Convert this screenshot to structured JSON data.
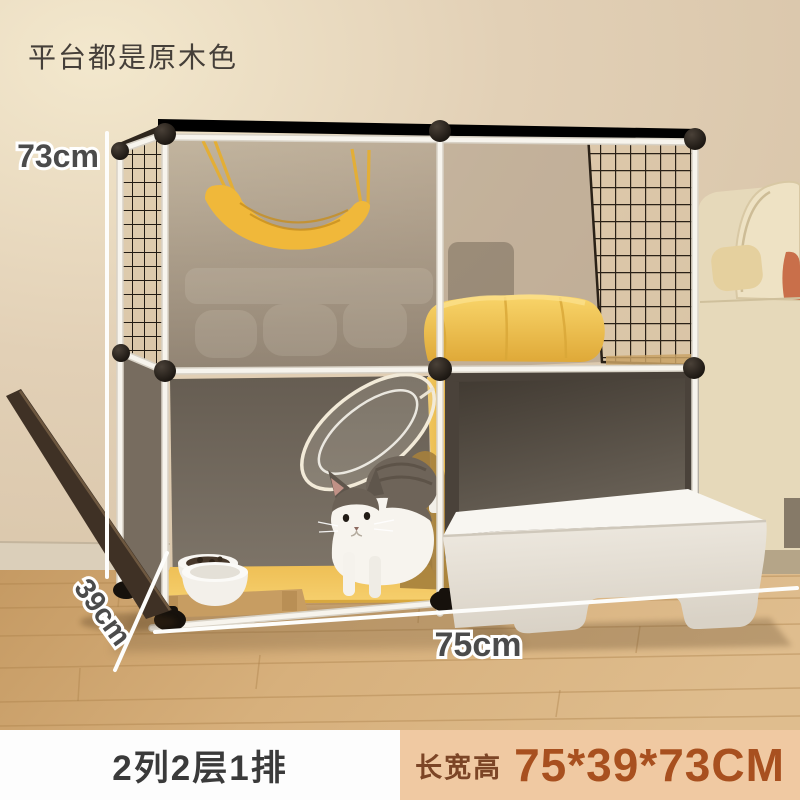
{
  "annotation": {
    "platform_note": "平台都是原木色"
  },
  "dimensions": {
    "height": "73cm",
    "depth": "39cm",
    "width": "75cm"
  },
  "footer": {
    "config_label": "2列2层1排",
    "size_label": "长宽高",
    "size_value": "75*39*73CM"
  },
  "colors": {
    "footer_size_bg": "#f0c9a2",
    "footer_size_text": "#a8501f",
    "footer_config_text": "#3a3a3a",
    "accent_yellow": "#f2c14e",
    "frame_white": "#f6f3ec",
    "connector_black": "#17120d"
  }
}
